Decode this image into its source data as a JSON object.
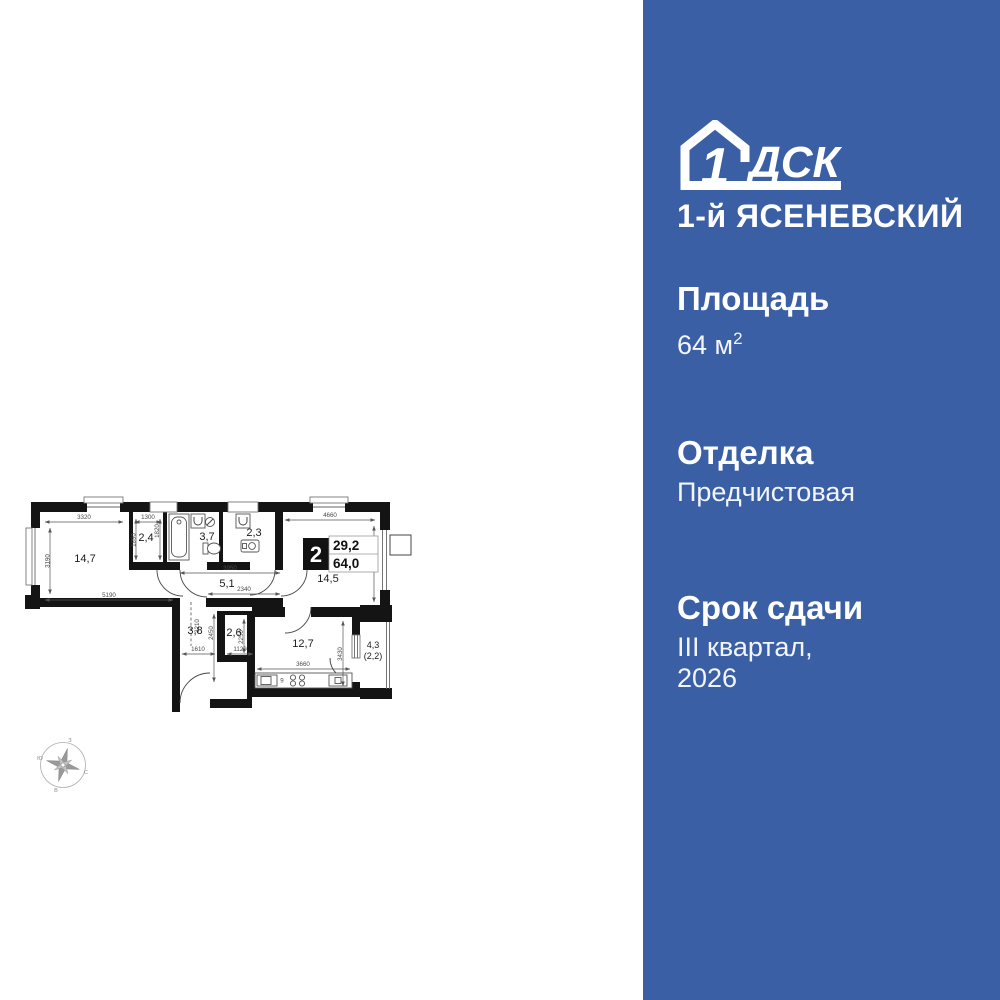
{
  "brand": {
    "logo_number": "1",
    "logo_letters": "ДСК",
    "project_name": "1-й ЯСЕНЕВСКИЙ"
  },
  "specs": {
    "area_label": "Площадь",
    "area_value": "64 м",
    "area_sup": "2",
    "finish_label": "Отделка",
    "finish_value": "Предчистовая",
    "deadline_label": "Срок сдачи",
    "deadline_line1": "III квартал,",
    "deadline_line2": "2026"
  },
  "plan": {
    "badge": {
      "rooms": "2",
      "living_area": "29,2",
      "total_area": "64,0"
    },
    "rooms": {
      "living": "14,7",
      "wardrobe": "2,4",
      "bathroom": "3,7",
      "wc": "2,3",
      "hall": "5,1",
      "bedroom": "14,5",
      "corridor": "3,8",
      "closet": "2,6",
      "kitchen": "12,7",
      "balcony": "4,3",
      "balcony_reduced": "(2,2)",
      "kitchen_mark": "9"
    },
    "dims": {
      "d3320": "3320",
      "d1300": "1300",
      "d4660": "4660",
      "d3190": "3190",
      "d1890": "1890",
      "d1820": "1820",
      "d5190": "5190",
      "d3950": "3950",
      "d2340": "2340",
      "d3150": "3150",
      "d3210": "3210",
      "d2450": "2450",
      "d2250": "2250",
      "d1610": "1610",
      "d1120": "1120",
      "d3660": "3660",
      "d3430": "3430"
    },
    "compass": {
      "north": "С",
      "south": "Ю",
      "east": "В",
      "west": "З"
    }
  },
  "colors": {
    "panel_bg": "#3A5FA5",
    "wall": "#141414",
    "dim_text": "#4a4a4a",
    "text_on_panel": "#ffffff"
  }
}
